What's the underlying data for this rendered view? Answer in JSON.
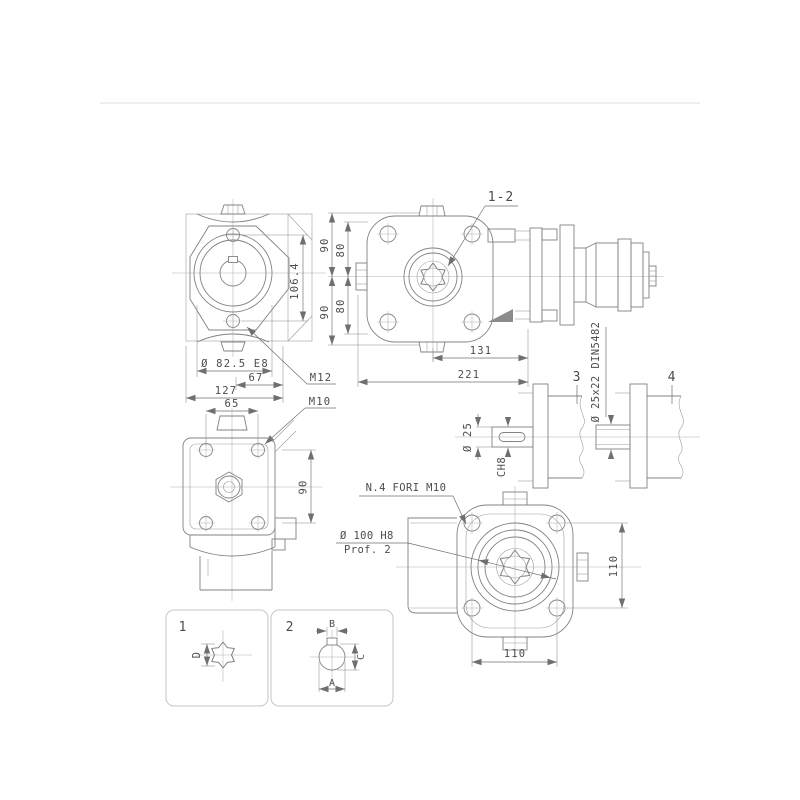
{
  "colors": {
    "background": "#ffffff",
    "line": "#828282",
    "dimension_line": "#6f6f6f",
    "text": "#4c4c4c",
    "panel_border": "#c6c6c6",
    "page_divider": "#e9e9e9"
  },
  "drawing": {
    "left_view": {
      "dim_106_4": "106.4",
      "dim_flange": "Ø 82.5 E8",
      "dim_67": "67",
      "dim_127": "127",
      "dim_65": "65",
      "callout_m12": "M12",
      "callout_m10": "M10"
    },
    "front_view": {
      "callout_spline": "1-2",
      "dim_90_top": "90",
      "dim_80_top": "80",
      "dim_80_bottom": "80",
      "dim_90_bottom": "90",
      "dim_131": "131",
      "dim_221": "221"
    },
    "top_view": {
      "dim_90": "90"
    },
    "shafts": {
      "label_3": "3",
      "label_4": "4",
      "dim_d25": "Ø 25",
      "chamfer": "CH8",
      "spline_spec": "Ø 25x22 DIN5482"
    },
    "bottom_view": {
      "callout_holes": "N.4 FORI M10",
      "callout_bore": "Ø 100 H8",
      "callout_depth": "Prof. 2",
      "dim_110_h": "110",
      "dim_110_v": "110"
    },
    "detail_1": {
      "label": "1",
      "dim_d": "D"
    },
    "detail_2": {
      "label": "2",
      "dim_a": "A",
      "dim_b": "B",
      "dim_c": "C"
    }
  }
}
